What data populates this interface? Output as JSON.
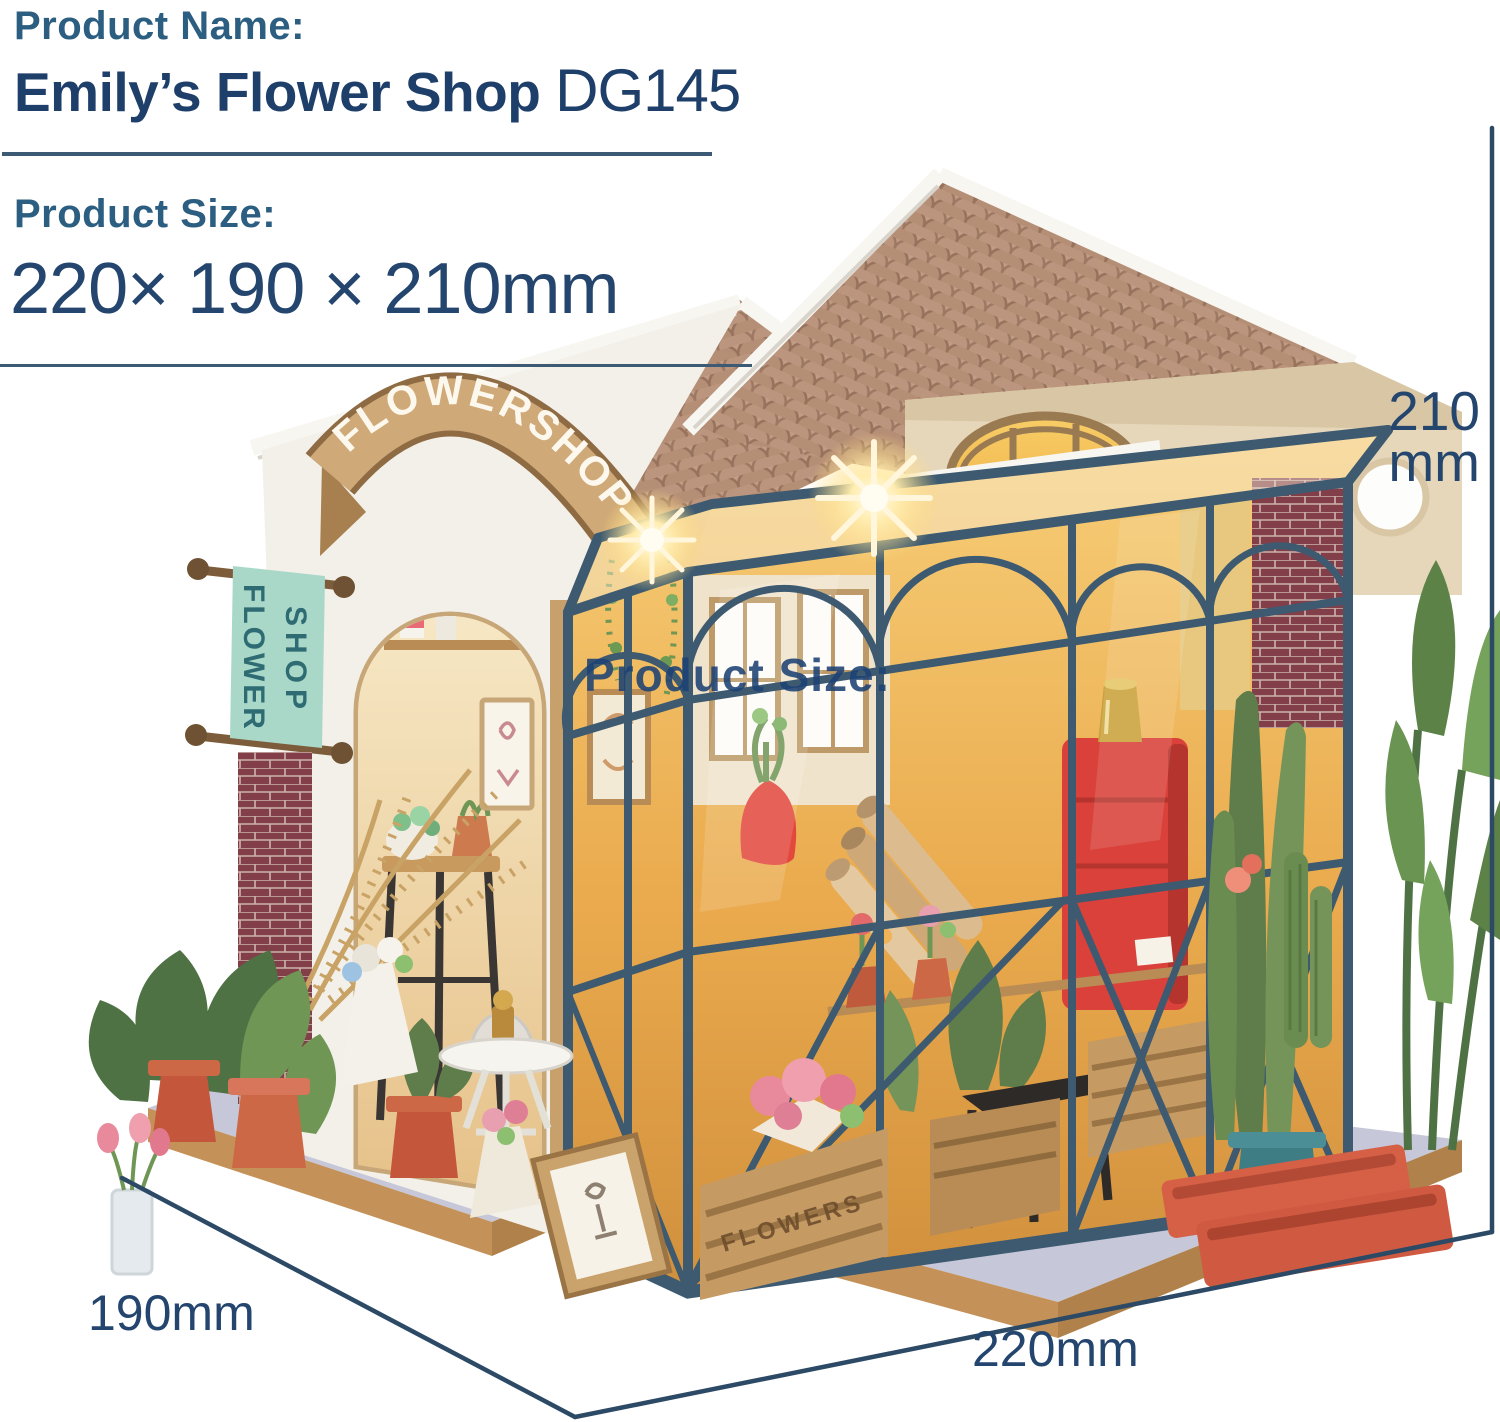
{
  "header": {
    "product_name_label": "Product Name:",
    "product_title": "Emily’s Flower Shop",
    "product_code": "DG145",
    "product_size_label": "Product Size:",
    "product_size_value": "220× 190 × 210mm"
  },
  "overlay": {
    "watermark_text": "Product Size:"
  },
  "dimensions": {
    "height_value": "210",
    "height_unit": "mm",
    "depth_label": "190mm",
    "width_label": "220mm"
  },
  "photo": {
    "description": "DIY miniature greenhouse flower-shop kit with lit interior, terracotta roof, plants and potted flowers on a wooden base",
    "signs": {
      "arch_banner": "FLOWERSHOP",
      "hanging_banner_line1": "FLOWER",
      "hanging_banner_line2": "SHOP",
      "crate_label": "FLOWERS"
    },
    "colors": {
      "navy_text": "#24456e",
      "title_navy": "#1e3f69",
      "teal_label": "#2b5e80",
      "line_navy": "#3c5a74",
      "dim_navy": "#2c4a66",
      "frame_blue": "#3d5a70",
      "roof_tile": "#b5907a",
      "interior_glow": "#f3ba55",
      "terracotta": "#c4573b",
      "banner_teal": "#a9d8c9",
      "banner_text": "#2e6b72",
      "cabinet_red": "#d9413a",
      "base_grey": "#c6c7d8",
      "base_wood": "#c49259",
      "facade_white": "#f3f0e9",
      "gable_cream": "#e7d7ba",
      "maroon_brick": "#823f49",
      "plant_green": "#5f7d4a",
      "plant_green_light": "#7b9c5e",
      "ribbon_tan": "#cfa977",
      "ribbon_border": "#8f6b44"
    }
  }
}
